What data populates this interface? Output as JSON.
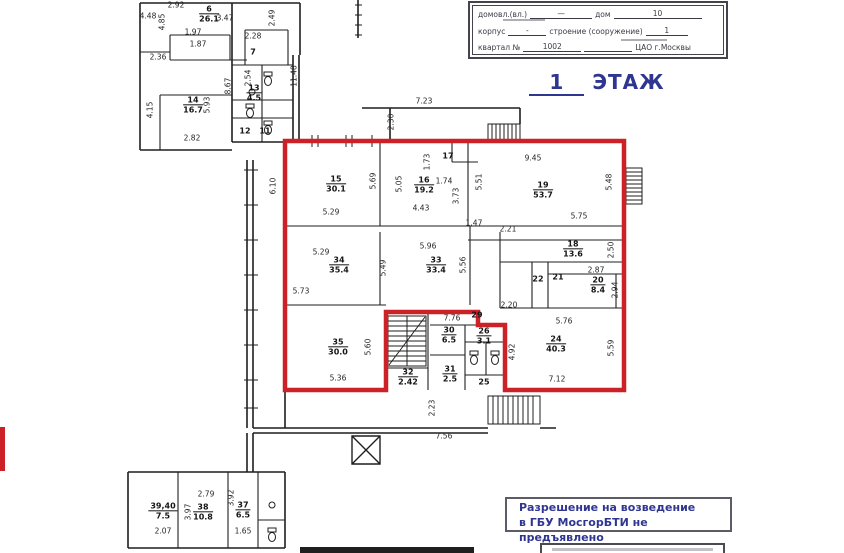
{
  "form": {
    "row1": {
      "label1": "домовл.(вл.)",
      "value1": "—",
      "label2": "дом",
      "value2": "10"
    },
    "row2": {
      "label1": "корпус",
      "value1": "-",
      "label2": "строение (сооружение)",
      "value2": "1"
    },
    "row3": {
      "label1": "квартал №",
      "value1": "1002",
      "value2": "ЦАО г.Москвы"
    }
  },
  "title": {
    "floor_number": "1",
    "floor_word": "ЭТАЖ"
  },
  "stamp": {
    "line1": "Разрешение на возведение",
    "line2": "в ГБУ МосгорБТИ не предъявлено"
  },
  "colors": {
    "outline_red": "#cc2127",
    "annotation_blue": "#2e3692",
    "wall_black": "#1f1f1f"
  },
  "rooms": [
    {
      "n": "6",
      "a": "26.1",
      "x": 209,
      "y": 14
    },
    {
      "n": "7",
      "x": 253,
      "y": 52
    },
    {
      "n": "13",
      "a": "4.5",
      "x": 254,
      "y": 93
    },
    {
      "n": "14",
      "a": "16.7",
      "x": 193,
      "y": 105
    },
    {
      "n": "12",
      "x": 245,
      "y": 131
    },
    {
      "n": "11",
      "x": 265,
      "y": 131
    },
    {
      "n": "15",
      "a": "30.1",
      "x": 336,
      "y": 184
    },
    {
      "n": "16",
      "a": "19.2",
      "x": 424,
      "y": 185
    },
    {
      "n": "17",
      "x": 448,
      "y": 156
    },
    {
      "n": "19",
      "a": "53.7",
      "x": 543,
      "y": 190
    },
    {
      "n": "34",
      "a": "35.4",
      "x": 339,
      "y": 265
    },
    {
      "n": "33",
      "a": "33.4",
      "x": 436,
      "y": 265
    },
    {
      "n": "18",
      "a": "13.6",
      "x": 573,
      "y": 249
    },
    {
      "n": "22",
      "x": 538,
      "y": 279
    },
    {
      "n": "21",
      "x": 558,
      "y": 277
    },
    {
      "n": "20",
      "a": "8.4",
      "x": 598,
      "y": 285
    },
    {
      "n": "35",
      "a": "30.0",
      "x": 338,
      "y": 347
    },
    {
      "n": "32",
      "a": "2.42",
      "x": 408,
      "y": 377
    },
    {
      "n": "30",
      "a": "6.5",
      "x": 449,
      "y": 335
    },
    {
      "n": "29",
      "x": 477,
      "y": 315
    },
    {
      "n": "26",
      "a": "3.1",
      "x": 484,
      "y": 336
    },
    {
      "n": "31",
      "a": "2.5",
      "x": 450,
      "y": 374
    },
    {
      "n": "25",
      "x": 484,
      "y": 382
    },
    {
      "n": "24",
      "a": "40.3",
      "x": 556,
      "y": 344
    },
    {
      "n": "39,40",
      "a": "7.5",
      "x": 163,
      "y": 511
    },
    {
      "n": "38",
      "a": "10.8",
      "x": 203,
      "y": 512
    },
    {
      "n": "37",
      "a": "6.5",
      "x": 243,
      "y": 510
    }
  ],
  "dims": [
    {
      "t": "2.92",
      "x": 176,
      "y": 5
    },
    {
      "t": "4.48",
      "x": 148,
      "y": 16
    },
    {
      "t": "3.47",
      "x": 225,
      "y": 18
    },
    {
      "t": "2.49",
      "x": 272,
      "y": 18,
      "r": 1
    },
    {
      "t": "4.85",
      "x": 162,
      "y": 22,
      "r": 1
    },
    {
      "t": "1.97",
      "x": 193,
      "y": 32
    },
    {
      "t": "2.28",
      "x": 253,
      "y": 36
    },
    {
      "t": "1.87",
      "x": 198,
      "y": 44
    },
    {
      "t": "2.36",
      "x": 158,
      "y": 57
    },
    {
      "t": "2.54",
      "x": 248,
      "y": 78,
      "r": 1
    },
    {
      "t": "8.67",
      "x": 228,
      "y": 86,
      "r": 1
    },
    {
      "t": "11.48",
      "x": 294,
      "y": 76,
      "r": 1
    },
    {
      "t": "4.15",
      "x": 150,
      "y": 110,
      "r": 1
    },
    {
      "t": "5.93",
      "x": 207,
      "y": 105,
      "r": 1
    },
    {
      "t": "2.82",
      "x": 192,
      "y": 138
    },
    {
      "t": "7.23",
      "x": 424,
      "y": 101
    },
    {
      "t": "2.30",
      "x": 391,
      "y": 122,
      "r": 1
    },
    {
      "t": "6.10",
      "x": 273,
      "y": 186,
      "r": 1
    },
    {
      "t": "9.45",
      "x": 533,
      "y": 158
    },
    {
      "t": "1.73",
      "x": 427,
      "y": 162,
      "r": 1
    },
    {
      "t": "1.74",
      "x": 444,
      "y": 181
    },
    {
      "t": "5.05",
      "x": 399,
      "y": 184,
      "r": 1
    },
    {
      "t": "5.69",
      "x": 373,
      "y": 181,
      "r": 1
    },
    {
      "t": "5.51",
      "x": 479,
      "y": 182,
      "r": 1
    },
    {
      "t": "5.48",
      "x": 609,
      "y": 182,
      "r": 1
    },
    {
      "t": "5.29",
      "x": 331,
      "y": 212
    },
    {
      "t": "4.43",
      "x": 421,
      "y": 208
    },
    {
      "t": "3.73",
      "x": 456,
      "y": 196,
      "r": 1
    },
    {
      "t": "5.75",
      "x": 579,
      "y": 216
    },
    {
      "t": "1.47",
      "x": 474,
      "y": 223
    },
    {
      "t": "2.21",
      "x": 508,
      "y": 229
    },
    {
      "t": "5.96",
      "x": 428,
      "y": 246
    },
    {
      "t": "5.29",
      "x": 321,
      "y": 252
    },
    {
      "t": "5.49",
      "x": 383,
      "y": 268,
      "r": 1
    },
    {
      "t": "5.56",
      "x": 463,
      "y": 265,
      "r": 1
    },
    {
      "t": "2.50",
      "x": 611,
      "y": 250,
      "r": 1
    },
    {
      "t": "2.87",
      "x": 596,
      "y": 270
    },
    {
      "t": "2.94",
      "x": 615,
      "y": 290,
      "r": 1
    },
    {
      "t": "5.73",
      "x": 301,
      "y": 291
    },
    {
      "t": "2.20",
      "x": 509,
      "y": 305
    },
    {
      "t": "5.60",
      "x": 368,
      "y": 347,
      "r": 1
    },
    {
      "t": "5.36",
      "x": 338,
      "y": 378
    },
    {
      "t": "7.76",
      "x": 452,
      "y": 318
    },
    {
      "t": "4.92",
      "x": 512,
      "y": 352,
      "r": 1
    },
    {
      "t": "5.76",
      "x": 564,
      "y": 321
    },
    {
      "t": "5.59",
      "x": 611,
      "y": 348,
      "r": 1
    },
    {
      "t": "7.12",
      "x": 557,
      "y": 379
    },
    {
      "t": "2.23",
      "x": 432,
      "y": 408,
      "r": 1
    },
    {
      "t": "7.56",
      "x": 444,
      "y": 436
    },
    {
      "t": "2.79",
      "x": 206,
      "y": 494
    },
    {
      "t": "3.97",
      "x": 188,
      "y": 512,
      "r": 1
    },
    {
      "t": "3.92",
      "x": 231,
      "y": 498,
      "r": 1
    },
    {
      "t": "2.07",
      "x": 163,
      "y": 531
    },
    {
      "t": "1.65",
      "x": 243,
      "y": 531
    }
  ]
}
